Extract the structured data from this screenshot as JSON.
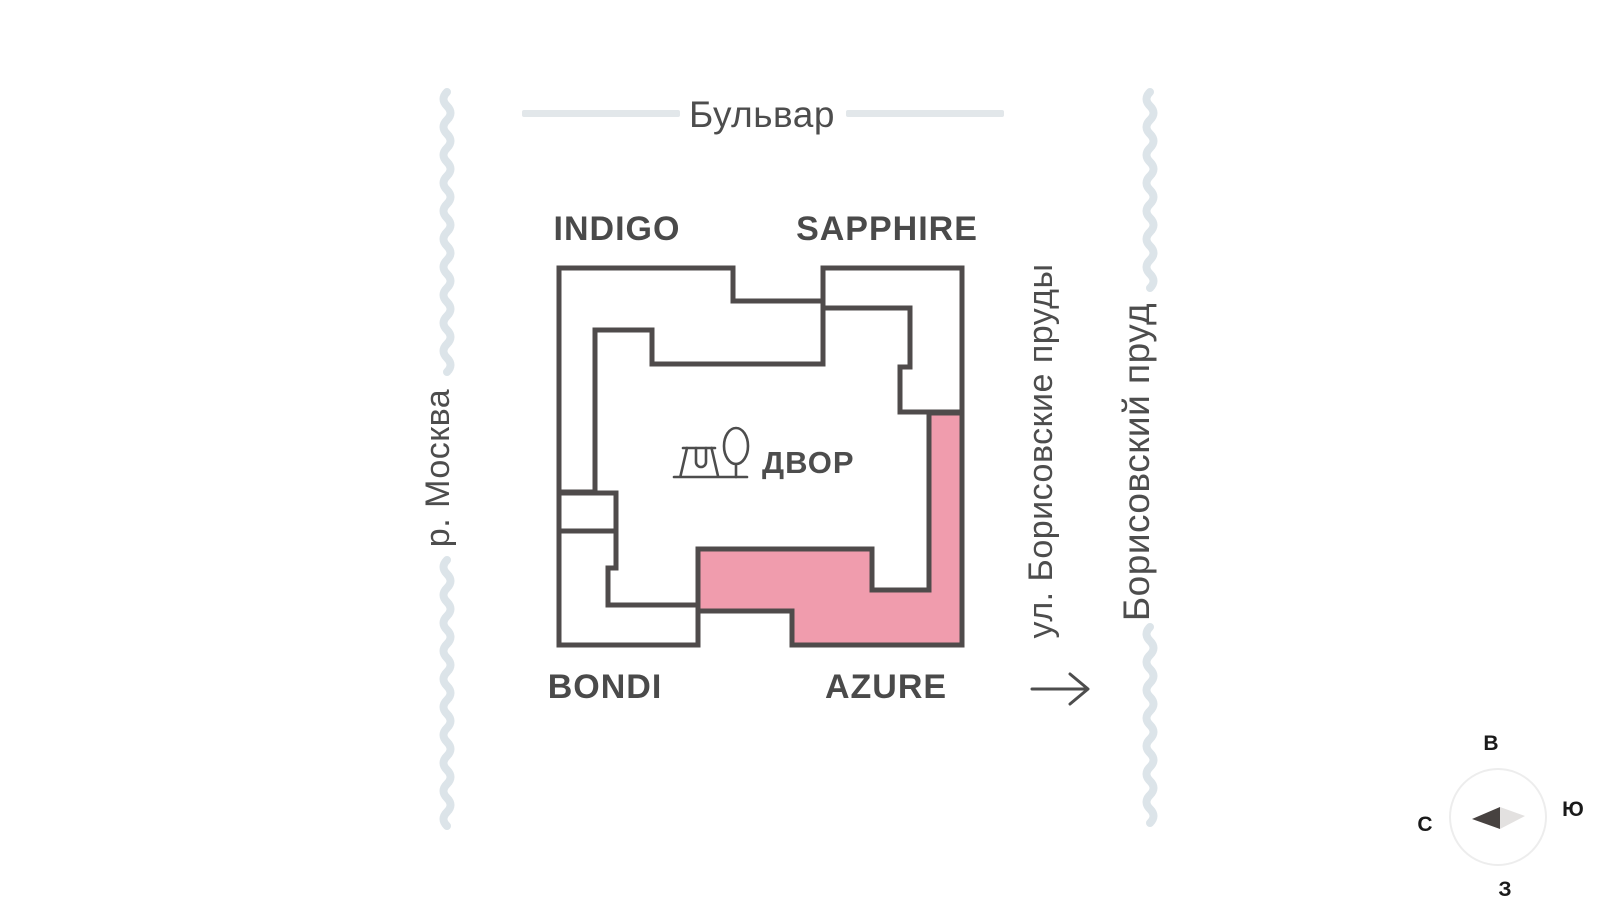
{
  "header": {
    "boulevard_label": "Бульвар"
  },
  "map": {
    "buildings": [
      {
        "id": "indigo",
        "label": "INDIGO",
        "highlighted": false
      },
      {
        "id": "sapphire",
        "label": "SAPPHIRE",
        "highlighted": false
      },
      {
        "id": "bondi",
        "label": "BONDI",
        "highlighted": false
      },
      {
        "id": "azure",
        "label": "AZURE",
        "highlighted": true
      }
    ],
    "courtyard_label": "ДВОР"
  },
  "landmarks": {
    "river_left": "р. Москва",
    "street_right": "ул. Борисовские пруды",
    "pond_right": "Борисовский пруд"
  },
  "compass": {
    "east": "В",
    "south": "Ю",
    "west": "З",
    "north": "С"
  },
  "colors": {
    "highlight": "#F09CAD",
    "outline": "#4F4B4B",
    "water": "#DCE4E9",
    "dash": "#E2E7EA",
    "text": "#4D4D4D",
    "needle_dark": "#474240",
    "needle_light": "#E3E1E0"
  }
}
